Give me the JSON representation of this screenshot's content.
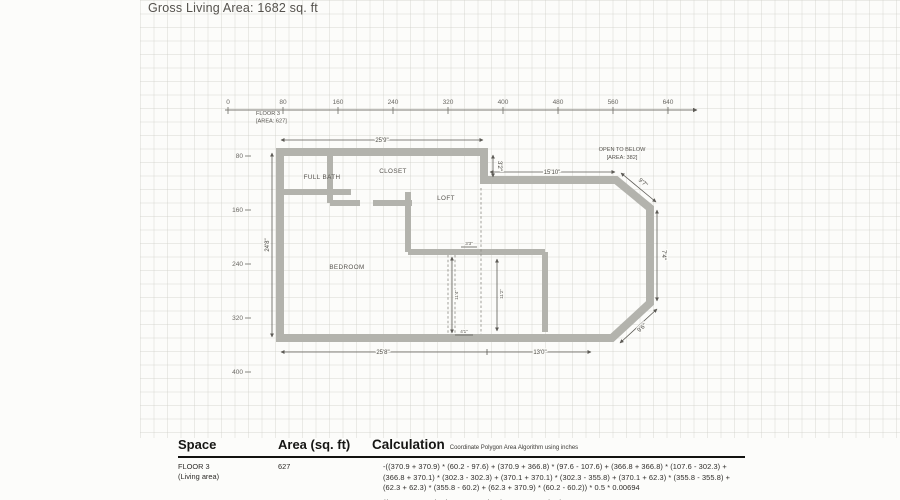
{
  "title": "Gross Living Area: 1682 sq. ft",
  "axes": {
    "x_ticks": [
      "0",
      "80",
      "160",
      "240",
      "320",
      "400",
      "480",
      "560",
      "640"
    ],
    "y_ticks": [
      "80",
      "160",
      "240",
      "320",
      "400"
    ]
  },
  "plan": {
    "floor_label_1": "FLOOR 3",
    "floor_label_2": "[AREA: 627]",
    "open_below_1": "OPEN TO BELOW",
    "open_below_2": "[AREA: 382]",
    "room_full_bath": "FULL BATH",
    "room_closet": "CLOSET",
    "room_loft": "LOFT",
    "room_bedroom": "BEDROOM",
    "dim_top": "25'9\"",
    "dim_otb_top": "15'10\"",
    "dim_step": "3'2\"",
    "dim_left": "24'8\"",
    "dim_bottom_left": "25'8\"",
    "dim_bottom_right": "13'0\"",
    "dim_diag_top": "9'7\"",
    "dim_right": "7'4\"",
    "dim_diag_bottom": "9'6\"",
    "dim_stair_w": "3'3\"",
    "dim_stair_h1": "11'4\"",
    "dim_stair_h2": "11'2\"",
    "dim_stair_b": "4'1\""
  },
  "table": {
    "col_space": "Space",
    "col_area": "Area (sq. ft)",
    "col_calc": "Calculation",
    "calc_note": "Coordinate Polygon Area Algorithm using inches",
    "rows": [
      {
        "space_1": "FLOOR 3",
        "space_2": "(Living area)",
        "area": "627",
        "calc": "-((370.9 + 370.9) * (60.2 - 97.6) + (370.9 + 366.8) * (97.6 - 107.6) + (366.8 + 366.8) * (107.6 - 302.3) + (366.8 + 370.1) * (302.3 - 302.3) + (370.1 + 370.1) * (302.3 - 355.8) + (370.1 + 62.3) * (355.8 - 355.8) + (62.3 + 62.3) * (355.8 - 60.2) + (62.3 + 370.9) * (60.2 - 60.2)) * 0.5 * 0.00694"
      },
      {
        "space_1": "OPEN TO BELOW",
        "space_2": "",
        "area": "382",
        "calc": "((561.9 + 586.7) * (97.6 - 149.2) + (586.7 + 561.9) * (149.2 -"
      }
    ]
  }
}
